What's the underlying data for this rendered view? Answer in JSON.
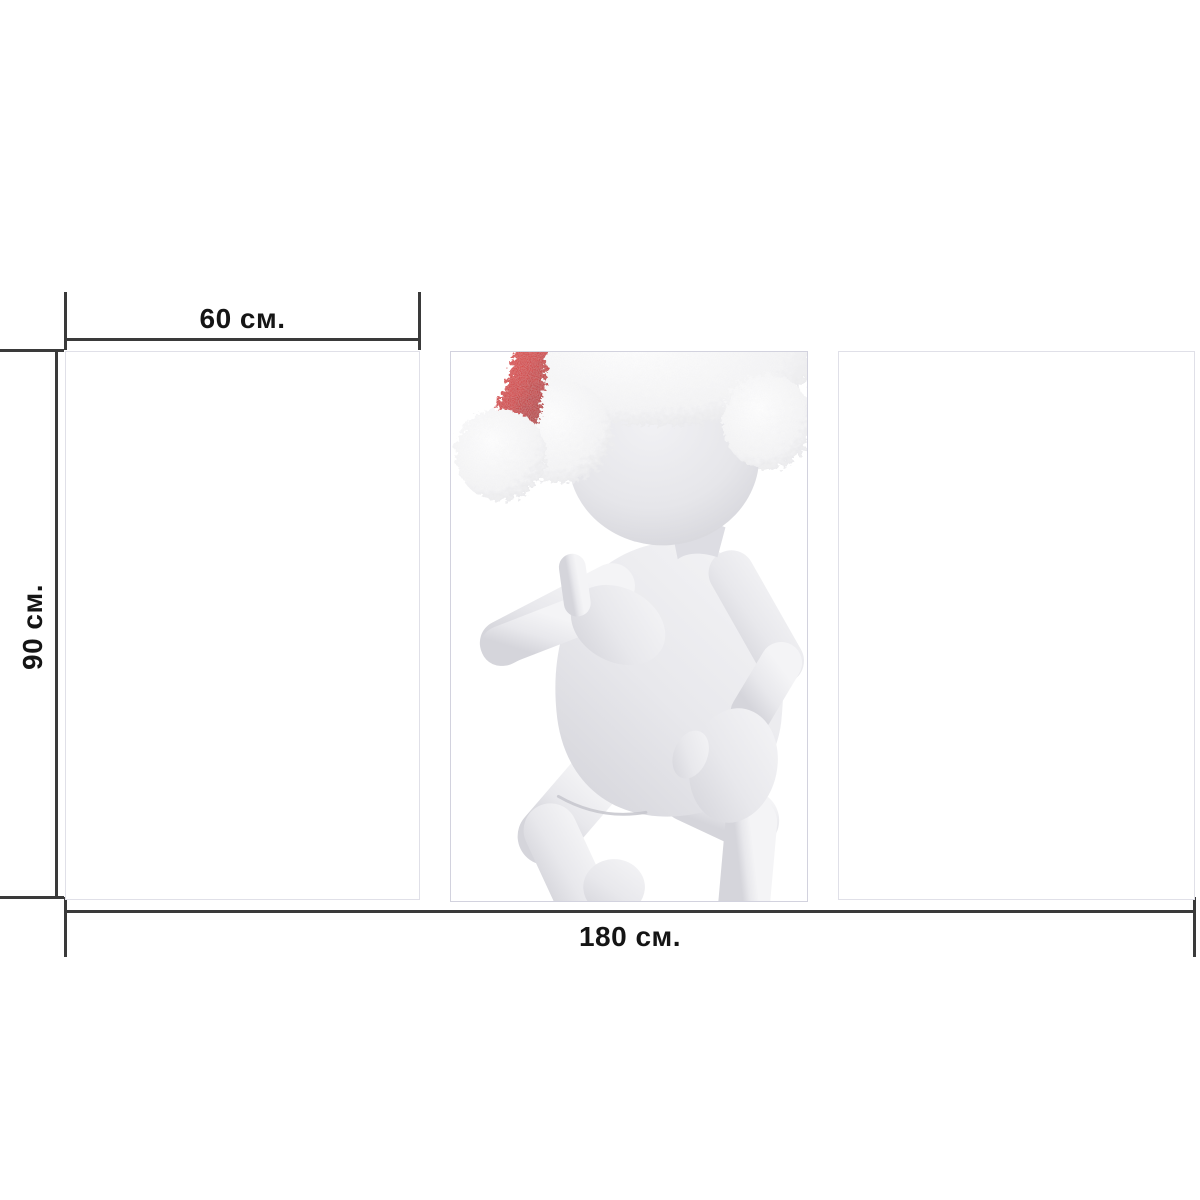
{
  "diagram": {
    "measurements": {
      "panel_width": "60 см.",
      "panel_height": "90 см.",
      "total_width": "180 см."
    },
    "panels": [
      {
        "position": "left",
        "content": "blank"
      },
      {
        "position": "center",
        "content": "santa-figure-artwork"
      },
      {
        "position": "right",
        "content": "blank"
      }
    ],
    "artwork": {
      "description": "3D white cartoon figure wearing a furry Santa hat, striding dance pose, hand raised to chest"
    },
    "colors": {
      "dimension_line": "#3a3a3a",
      "label_text": "#151515",
      "panel_border": "#d9d9e2",
      "background": "#ffffff",
      "hat_red": "#cf1f1f",
      "hat_fur": "#f6f6f7",
      "figure_body": "#e8e8ec"
    }
  }
}
